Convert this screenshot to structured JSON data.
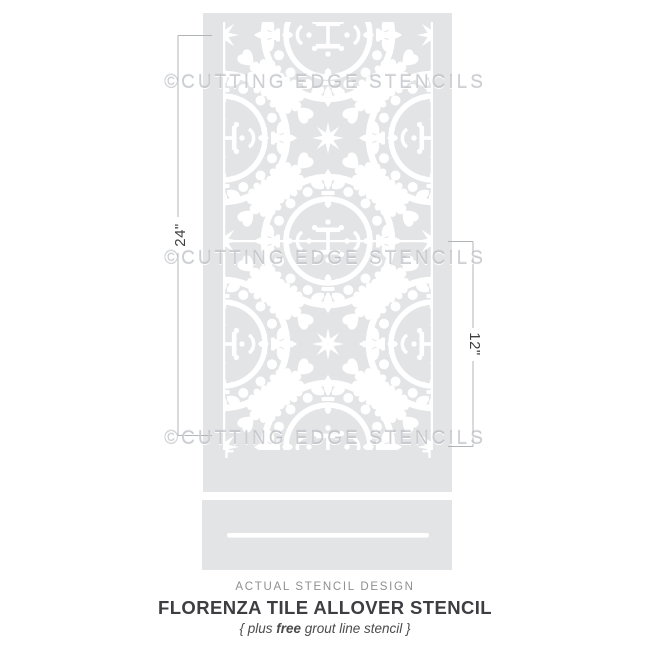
{
  "image": {
    "type": "stencil-product-illustration",
    "background_color": "#ffffff"
  },
  "watermark": {
    "text": "©CUTTING EDGE STENCILS",
    "rows": 3,
    "color": "#a5a8ae"
  },
  "stencil_sheet": {
    "description": "Florenza tile allover stencil sheet with ornate cut pattern",
    "sheet_color": "#e3e4e6",
    "cutout_color": "#ffffff"
  },
  "grout_stencil": {
    "description": "free grout line stencil strip",
    "sheet_color": "#e3e4e6",
    "slot_color": "#ffffff"
  },
  "dimensions": {
    "height_label": "24\"",
    "repeat_label": "12\"",
    "line_color": "#b2b5b8",
    "label_color": "#3d3e40"
  },
  "caption": {
    "kicker": "ACTUAL STENCIL DESIGN",
    "title": "FLORENZA TILE ALLOVER STENCIL",
    "subtitle_pre": "{ plus ",
    "subtitle_bold": "free",
    "subtitle_post": " grout line stencil }"
  }
}
